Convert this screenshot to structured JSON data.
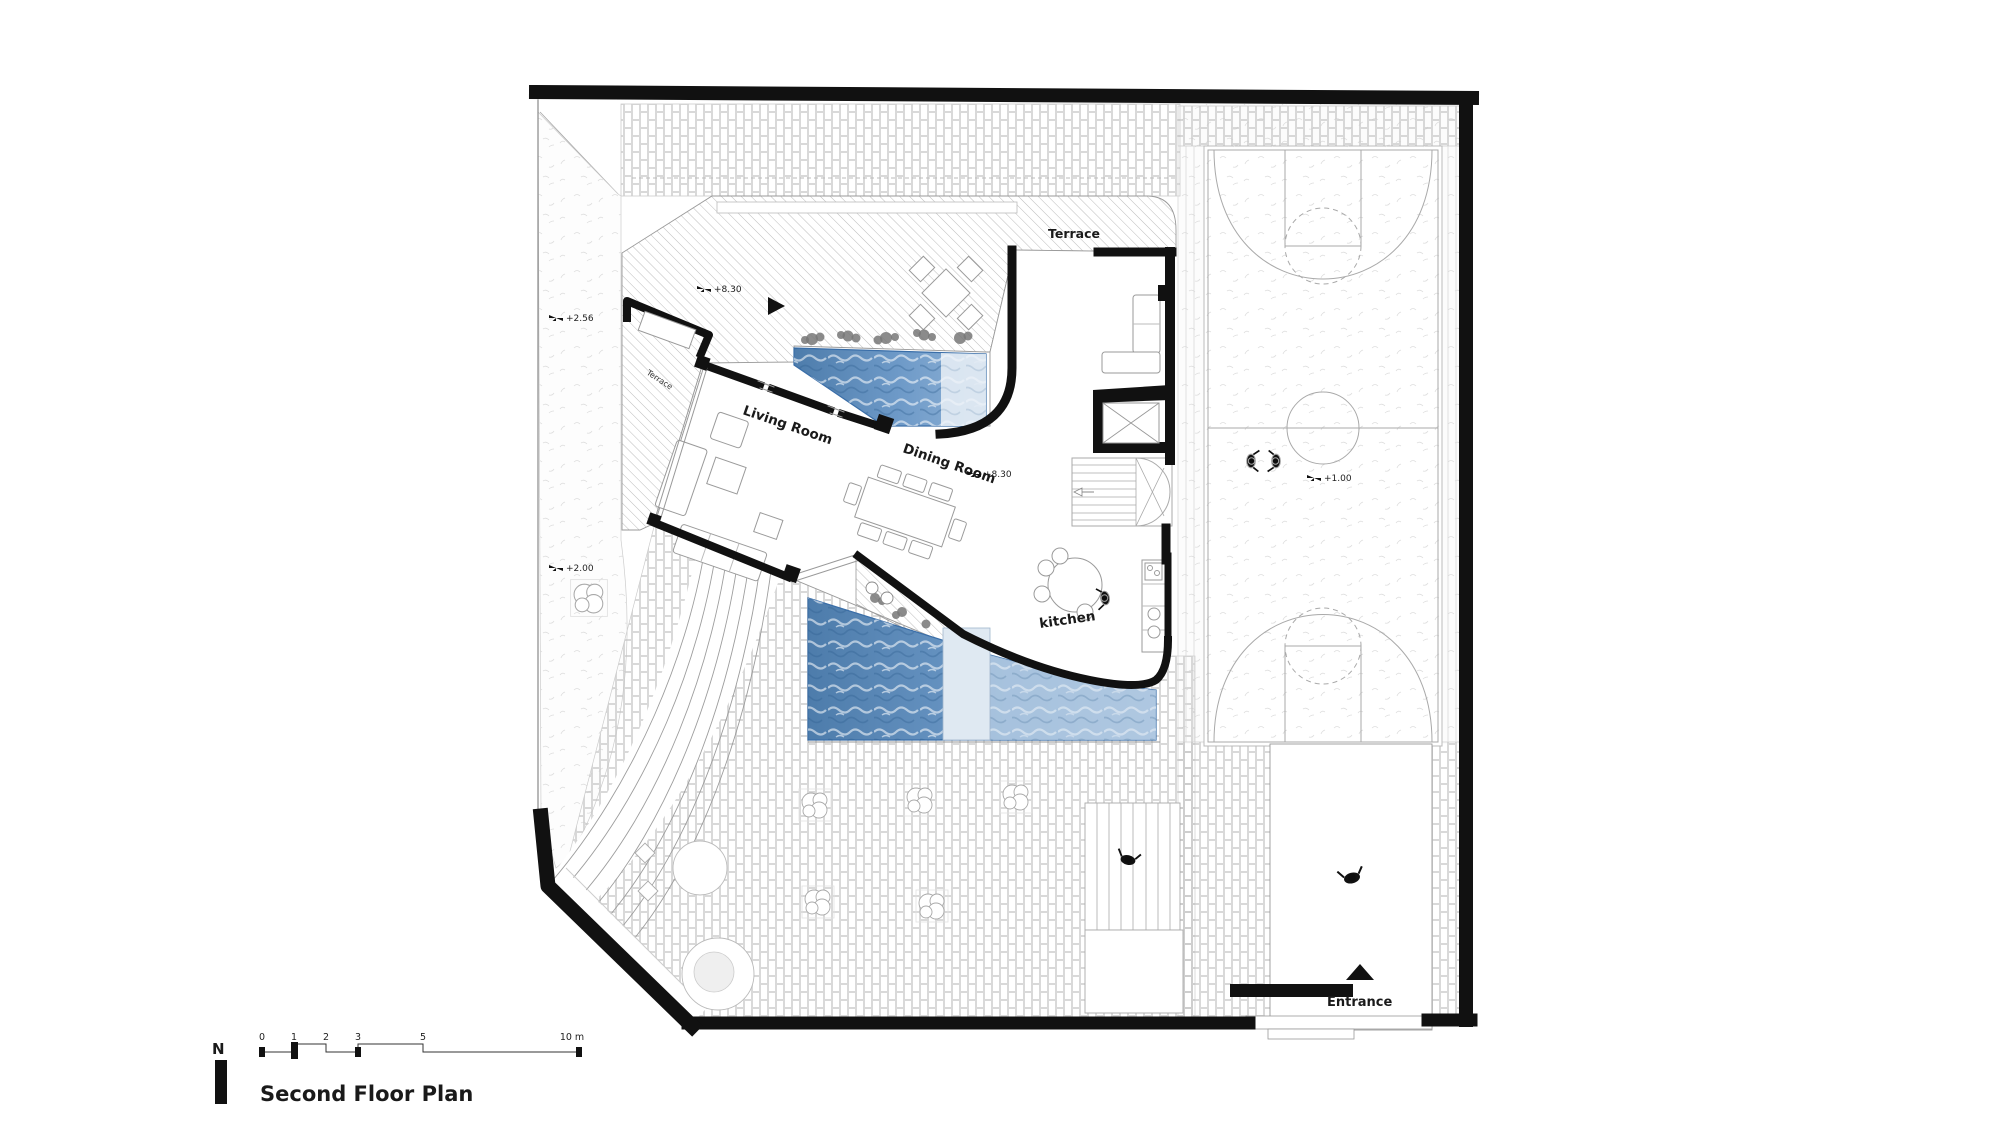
{
  "header": {
    "plan_title": "Second Floor Plan",
    "north_label": "N"
  },
  "scale_bar": {
    "tick_labels": [
      "0",
      "1",
      "2",
      "3",
      "5",
      "10 m"
    ]
  },
  "room_labels": {
    "terrace_main": "Terrace",
    "terrace_side": "Terrace",
    "living_room": "Living Room",
    "dining_room": "Dining Room",
    "kitchen": "kitchen",
    "entrance": "Entrance"
  },
  "level_markers": {
    "terrace": "+8.30",
    "dining": "+8.30",
    "garden_upper": "+2.56",
    "garden_lower": "+2.00",
    "court": "+1.00"
  },
  "colors": {
    "wall_black": "#111111",
    "pool_deep": "#4d7cab",
    "pool_shallow": "#b9cfe4",
    "hatch_line": "#b5b5b5",
    "brick_line": "#c9c9c9"
  }
}
